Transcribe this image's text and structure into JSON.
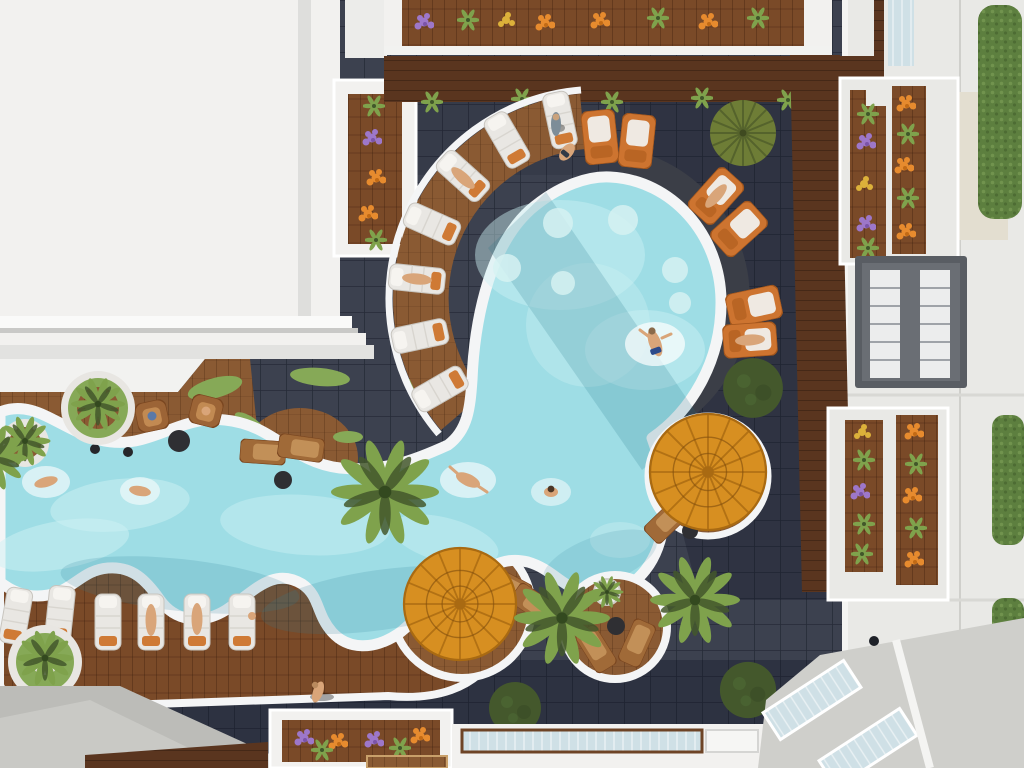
{
  "scene": {
    "description": "Top-down aerial rendering of a hotel courtyard: a freeform lazy-river lagoon pool winding from the left into a large round pool, surrounded by dark slate tiles, curved wooden sun decks with white and orange loungers, two amber parasols, palm trees, a large white rooftop at top-left, flower planter balconies, and an apartment facade with hedges on the right.",
    "inventory": {
      "round_main_pool": 1,
      "lazy_river_pool": 1,
      "swimmers": 5,
      "white_loungers": 13,
      "orange_loungers": 6,
      "brown_loungers_chairs": 7,
      "armchairs": 2,
      "parasols": 2,
      "palm_trees": 8,
      "fan_palms": 1,
      "round_planters": 4,
      "balcony_flower_planters": 5,
      "hedge_blocks": 3,
      "people_total": 15
    }
  },
  "palette": {
    "roof-white": "#f2f1ef",
    "wall-white": "#e9e9e6",
    "wall-beige": "#e3ded0",
    "concrete": "#bcbcb8",
    "tile-dark": "#3c414f",
    "water": "#9edde5",
    "water-light": "#cdf1f3",
    "rim-white": "#f4f5f6",
    "stone-dark": "#3b3e47",
    "wood-a": "#8a5a33",
    "wood-b": "#7a4a28",
    "wood-walk": "#5a351f",
    "parasol": "#d78f21",
    "parasol-dark": "#a96a12",
    "lounger-white": "#e9e7e3",
    "cushion-orange": "#cf7a35",
    "lounger-orange": "#cd7430",
    "chair-brown": "#9c6436",
    "green-palm": "#7fa24c",
    "green-deep": "#44582c",
    "grass": "#86a957",
    "hedge": "#5d7f3f",
    "flower-purple": "#9d77c9",
    "flower-orange": "#e78b2e",
    "flower-yellow": "#dcb13a",
    "skin": "#d9a579",
    "glass": "#cfe0e6"
  }
}
